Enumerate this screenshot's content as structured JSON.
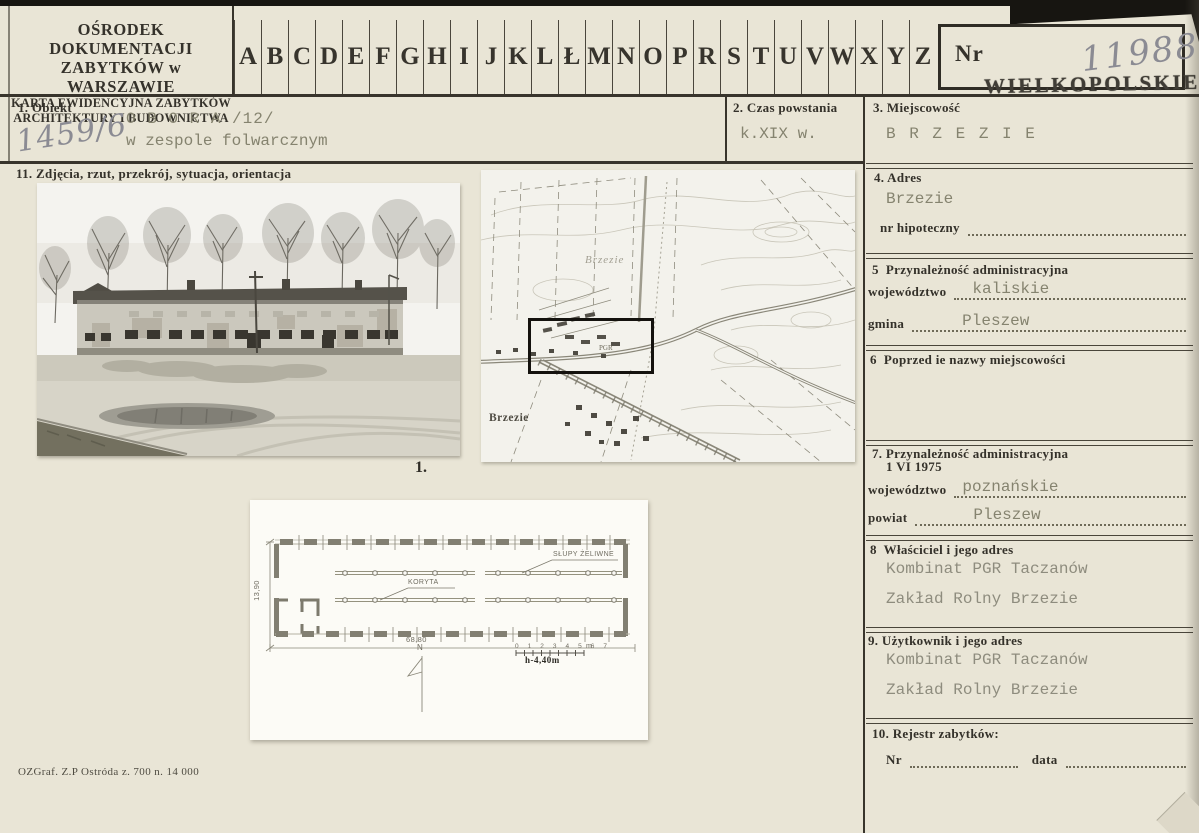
{
  "org": {
    "line1": "OŚRODEK DOKUMENTACJI",
    "line2": "ZABYTKÓW w WARSZAWIE",
    "line3": "KARTA EWIDENCYJNA ZABYTKÓW",
    "line4": "ARCHITEKTURY I BUDOWNICTWA"
  },
  "alphabet": [
    "A",
    "B",
    "C",
    "D",
    "E",
    "F",
    "G",
    "H",
    "I",
    "J",
    "K",
    "L",
    "Ł",
    "M",
    "N",
    "O",
    "P",
    "R",
    "S",
    "T",
    "U",
    "V",
    "W",
    "X",
    "Y",
    "Z"
  ],
  "nr_box": {
    "label": "Nr",
    "handwritten_number": "11988",
    "stamp": "WIELKOPOLSKIE"
  },
  "fields": {
    "obiekt": {
      "label": "1. Obiekt",
      "value_line1": "O B O R A /12/",
      "value_line2": "w zespole folwarcznym",
      "handwritten_ref": "1459/6"
    },
    "czas_powstania": {
      "label": "2. Czas powstania",
      "value": "k.XIX w."
    },
    "miejscowosc": {
      "label": "3. Miejscowość",
      "value": "B R Z E Z I E"
    },
    "adres": {
      "label": "4. Adres",
      "value": "Brzezie",
      "sub_label": "nr hipoteczny"
    },
    "przynaleznosc": {
      "label": "5  Przynależność administracyjna",
      "wojewodztwo_label": "województwo",
      "wojewodztwo_value": "kaliskie",
      "gmina_label": "gmina",
      "gmina_value": "Pleszew"
    },
    "poprzednie_nazwy": {
      "label": "6  Poprzed ie nazwy miejscowości"
    },
    "przynaleznosc_1975": {
      "label_line1": "7. Przynależność administracyjna",
      "label_line2": "1 VI 1975",
      "wojewodztwo_label": "województwo",
      "wojewodztwo_value": "poznańskie",
      "powiat_label": "powiat",
      "powiat_value": "Pleszew"
    },
    "wlasciciel": {
      "label": "8  Właściciel i jego adres",
      "value_line1": "Kombinat PGR Taczanów",
      "value_line2": "Zakład Rolny Brzezie"
    },
    "uzytkownik": {
      "label": "9. Użytkownik i jego adres",
      "value_line1": "Kombinat PGR Taczanów",
      "value_line2": "Zakład Rolny Brzezie"
    },
    "rejestr": {
      "label": "10. Rejestr zabytków:",
      "nr_label": "Nr",
      "data_label": "data"
    },
    "zdjecia": {
      "label": "11. Zdjęcia, rzut, przekrój, sytuacja, orientacja"
    }
  },
  "photo_caption": "1.",
  "map": {
    "label_top": "Brzezie",
    "label_bottom": "Brzezie",
    "pgr_label": "PGR"
  },
  "plan": {
    "columns_label": "SŁUPY ŻELIWNE",
    "troughs_label": "KORYTA",
    "length_dim": "68,80",
    "width_dim": "13,90",
    "north_label": "N",
    "scale_numbers": "0 1 2 3 4 5 6 7",
    "scale_unit": "m",
    "height_note": "h-4,40m"
  },
  "footer_note": "OZGraf. Z.P Ostróda z. 700 n. 14 000",
  "colors": {
    "paper": "#e9e5d6",
    "ink": "#35322b",
    "typewriter": "#85836f",
    "pencil": "#8b8b93",
    "scan_edge": "#171511"
  }
}
